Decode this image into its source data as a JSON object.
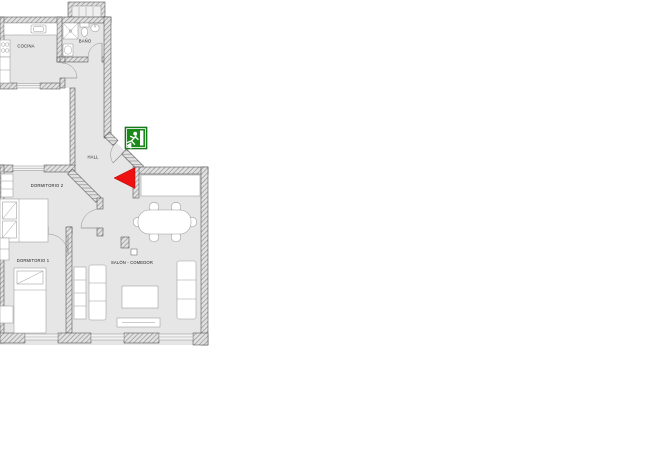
{
  "plan": {
    "rooms": {
      "cocina": {
        "label": "COCINA"
      },
      "bano": {
        "label": "BAÑO"
      },
      "hall": {
        "label": "HALL"
      },
      "dormitorio2": {
        "label": "DORMITORIO 2"
      },
      "dormitorio1": {
        "label": "DORMITORIO 1"
      },
      "salon": {
        "label": "SALÓN - COMEDOR"
      }
    },
    "signs": {
      "emergency_exit": {
        "name": "emergency-exit-sign",
        "pictogram": "running-man-with-arrow",
        "color": "#1b8a1b"
      },
      "entrance_arrow": {
        "name": "entrance-arrow",
        "direction": "left",
        "color": "#ee1111"
      }
    },
    "colors": {
      "floor": "#e6e6e6",
      "wall_hatch": "#8f8f8f",
      "wall_outline": "#4d4d4d",
      "furniture": "#ffffff",
      "background": "#ffffff"
    }
  }
}
